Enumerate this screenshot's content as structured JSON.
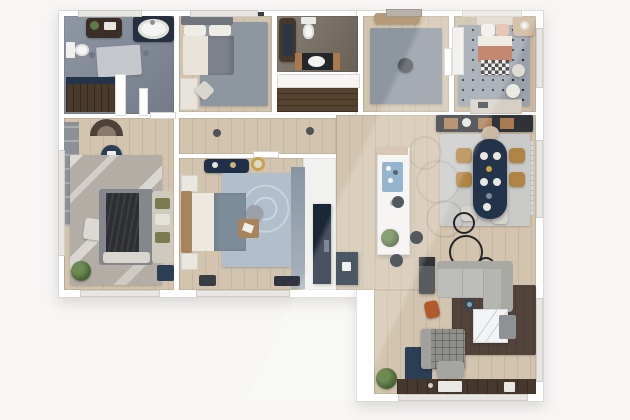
{
  "meta": {
    "description": "Photorealistic 3D-rendered top-down floor plan of an apartment, L-shaped footprint, no visible text labels",
    "view": "top-down render",
    "visible_text": ""
  },
  "palette": {
    "background": "#f7f6f5",
    "walls": "#ffffff",
    "wood_floor": "#d2c4ae",
    "bathroom_tile": "#858d9a",
    "wc_tile": "#7d7469",
    "closet_wood": "#55422f",
    "rug_gray": "#8e96a0",
    "rug_dotted": "#9aa1ab",
    "rug_blue": "#b1becb",
    "rug_mottled": "#b4ada5",
    "rug_brown": "#52443a",
    "rug_navy": "#2c3e55",
    "dining_table_navy": "#22334a",
    "chair_mustard": "#b08442",
    "sofa_gray": "#bdbdb9",
    "armchair_gray": "#8f908c",
    "coffee_table_marble": "#f3f4f6",
    "kids_blanket_terracotta": "#b66a4c",
    "plant_green": "#4e6b3c",
    "kitchen_console_dark": "#2f3237",
    "cabinet_wood": "#a87a50",
    "desk_chair_orange": "#b05a2e"
  },
  "rooms": [
    {
      "name": "main bathroom",
      "features": [
        "bathtub",
        "vanity cabinet",
        "toilet",
        "walk-in shower",
        "bath rug"
      ]
    },
    {
      "name": "guest bedroom",
      "features": [
        "double bed",
        "gray rug",
        "desk",
        "chair"
      ]
    },
    {
      "name": "wc",
      "features": [
        "wall-hung toilet",
        "vanity sink",
        "dark cabinet"
      ]
    },
    {
      "name": "hall closet",
      "features": [
        "sliding door",
        "wood wardrobe interior"
      ]
    },
    {
      "name": "entry hall",
      "features": [
        "console",
        "gray rug",
        "pouf",
        "entry door"
      ]
    },
    {
      "name": "kids bedroom",
      "features": [
        "single bed with terracotta blanket",
        "polka-dot rug",
        "wardrobe",
        "nightstand",
        "desk"
      ]
    },
    {
      "name": "corridor",
      "features": [
        "two ceiling lights",
        "door leaves"
      ]
    },
    {
      "name": "master bedroom",
      "features": [
        "wardrobe",
        "arched headboard niche",
        "navy pouf",
        "mottled rug",
        "double bed with dark throw",
        "daybed",
        "white pouf",
        "plant",
        "navy bench"
      ]
    },
    {
      "name": "third bedroom",
      "features": [
        "navy dresser",
        "gold mirror",
        "bed with wood headboard",
        "swirl blue rug",
        "round pouf",
        "wood tray platform",
        "tall wardrobe",
        "nightstands"
      ]
    },
    {
      "name": "storage nook",
      "features": [
        "tall navy cabinet",
        "low navy unit"
      ]
    },
    {
      "name": "open kitchen dining living",
      "features": [
        "dark sideboard",
        "kitchen island with stools",
        "oval navy dining table",
        "mustard chairs",
        "dining rug",
        "decor circles",
        "tv console",
        "orange desk chair",
        "gray corner sofa",
        "side table",
        "brown rug",
        "marble coffee table",
        "waffle armchair",
        "navy rug",
        "plants",
        "window bench strip",
        "radiator"
      ]
    }
  ]
}
